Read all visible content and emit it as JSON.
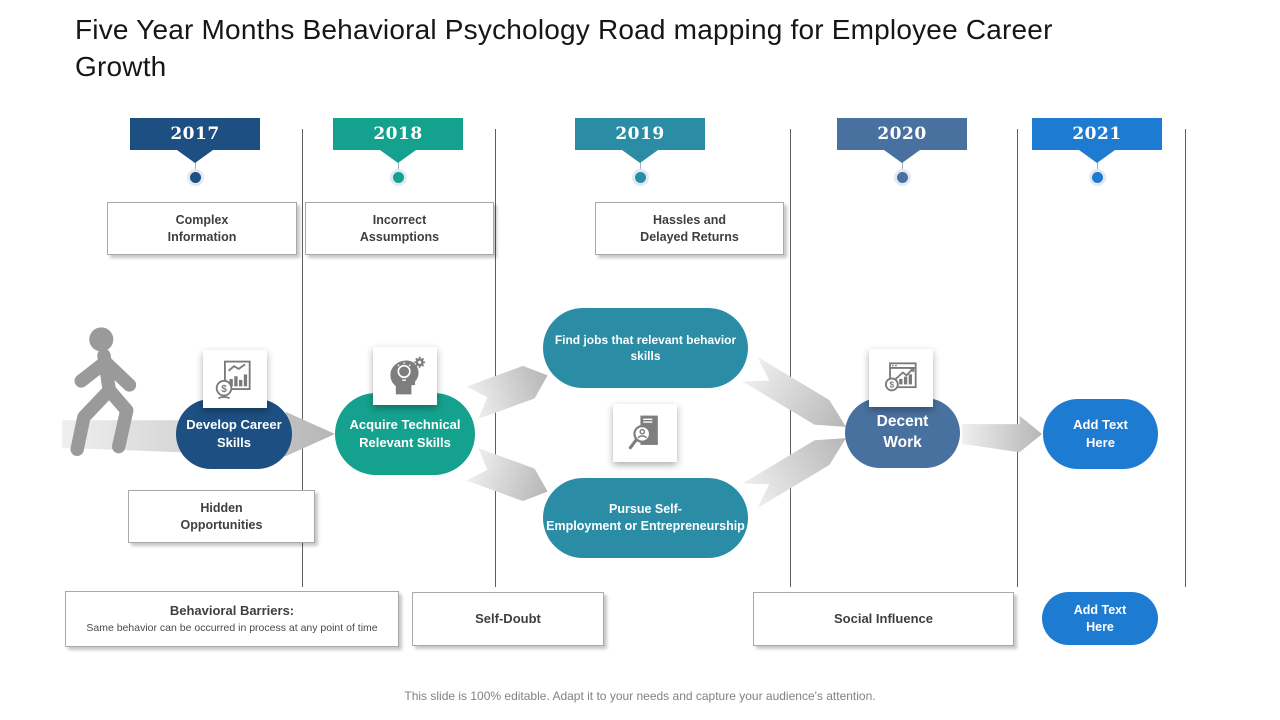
{
  "title": "Five Year Months Behavioral Psychology Road mapping for Employee Career Growth",
  "footer": "This slide is 100% editable. Adapt it to your needs and capture your audience's attention.",
  "palette": {
    "year_2017": "#1d4f82",
    "year_2018": "#14a18d",
    "year_2019": "#2b8ca6",
    "year_2020": "#49719f",
    "year_2021": "#1e7bd2",
    "arrow_gray": "#c9c9c9",
    "box_border": "#a9a9a9",
    "box_text": "#3f3f3f",
    "divider": "#5f5f5f"
  },
  "years": [
    {
      "label": "2017",
      "color": "#1d4f82"
    },
    {
      "label": "2018",
      "color": "#14a18d"
    },
    {
      "label": "2019",
      "color": "#2b8ca6"
    },
    {
      "label": "2020",
      "color": "#49719f"
    },
    {
      "label": "2021",
      "color": "#1e7bd2"
    }
  ],
  "obstacles": {
    "complex": "Complex\nInformation",
    "incorrect": "Incorrect\nAssumptions",
    "hassles": "Hassles  and\nDelayed Returns",
    "hidden": "Hidden\nOpportunities",
    "behavioral_title": "Behavioral Barriers:",
    "behavioral_sub": "Same behavior can be occurred in process at any point of time",
    "self_doubt": "Self-Doubt",
    "social_influence": "Social Influence"
  },
  "milestones": {
    "develop": "Develop Career\nSkills",
    "acquire": "Acquire Technical\nRelevant Skills",
    "find_jobs": "Find jobs that relevant behavior\nskills",
    "pursue": "Pursue  Self-\nEmployment or Entrepreneurship",
    "decent": "Decent\nWork",
    "add_text": "Add Text\nHere",
    "add_text_bottom": "Add Text\nHere"
  },
  "icons": {
    "walking_person": "walking-person-icon",
    "finance_growth": "finance-growth-chart-icon",
    "idea_mind": "idea-mind-gear-icon",
    "candidate_search": "candidate-search-icon",
    "profit_analysis": "profit-analysis-icon"
  }
}
